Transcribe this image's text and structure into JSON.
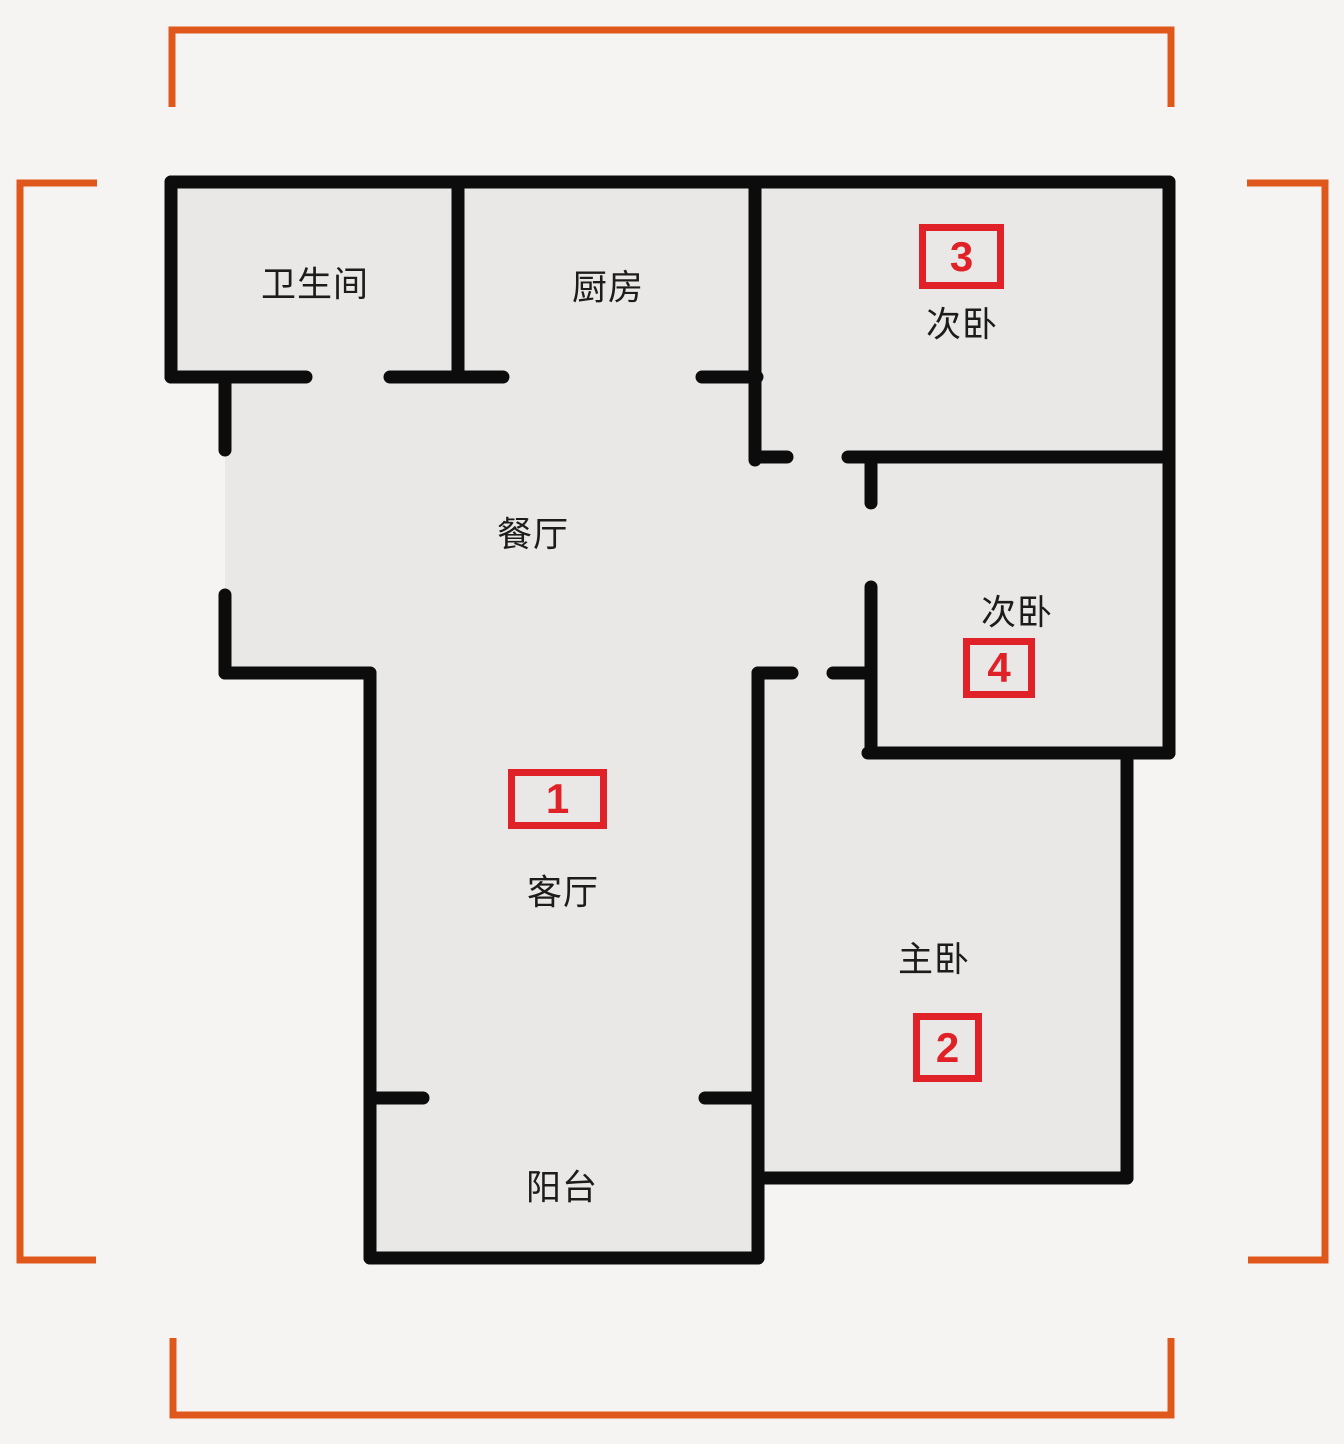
{
  "title": "apartment-floor-plan",
  "colors": {
    "background": "#f5f4f2",
    "room_fill": "#e9e8e6",
    "wall": "#0c0c0c",
    "bracket_orange": "#e0571c",
    "marker_red": "#e02127",
    "label_text": "#1c1c1c"
  },
  "rooms": [
    {
      "id": "bathroom",
      "label": "卫生间"
    },
    {
      "id": "kitchen",
      "label": "厨房"
    },
    {
      "id": "bedroom-top-right",
      "label": "次卧"
    },
    {
      "id": "dining-room",
      "label": "餐厅"
    },
    {
      "id": "bedroom-middle-right",
      "label": "次卧"
    },
    {
      "id": "living-room",
      "label": "客厅"
    },
    {
      "id": "master-bedroom",
      "label": "主卧"
    },
    {
      "id": "balcony",
      "label": "阳台"
    }
  ],
  "markers": [
    {
      "number": "1",
      "room": "客厅"
    },
    {
      "number": "2",
      "room": "主卧"
    },
    {
      "number": "3",
      "room": "次卧"
    },
    {
      "number": "4",
      "room": "次卧"
    }
  ]
}
